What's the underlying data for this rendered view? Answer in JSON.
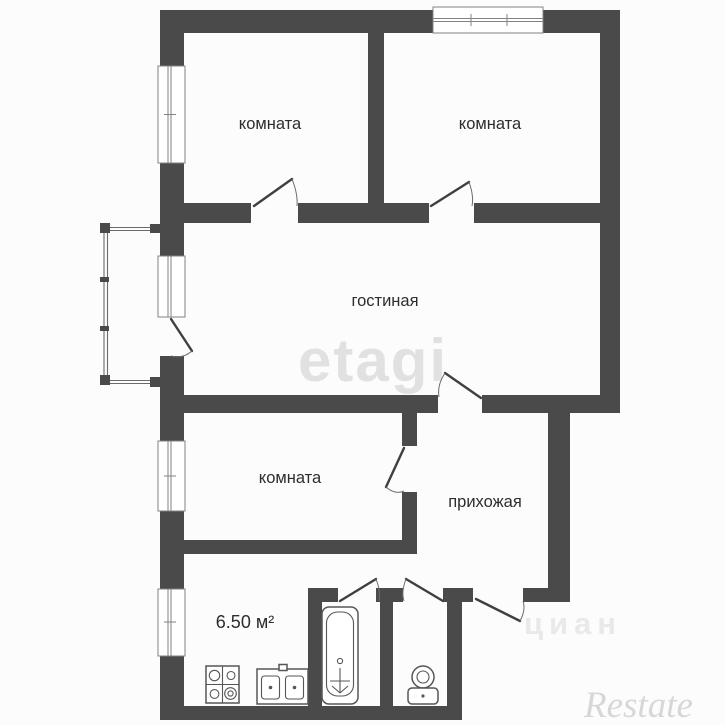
{
  "plan_type": "apartment floor plan",
  "rooms": {
    "top_left": {
      "label": "комната"
    },
    "top_right": {
      "label": "комната"
    },
    "living": {
      "label": "гостиная"
    },
    "bottom": {
      "label": "комната"
    },
    "hallway": {
      "label": "прихожая"
    },
    "kitchen": {
      "area_label": "6.50 м²"
    }
  },
  "fixtures": {
    "bathtub": "bathtub-icon",
    "stove": "stove-icon",
    "sink": "double-sink-icon",
    "toilet": "toilet-icon"
  },
  "watermarks": {
    "center": "etagi",
    "entrance": "циан",
    "bottom_right": "Restate"
  },
  "colors": {
    "wall": "#4a4a4a",
    "background": "#fcfcfc",
    "label_text": "#2d2d2d",
    "watermark_light_gray": "#e1e1e1"
  }
}
